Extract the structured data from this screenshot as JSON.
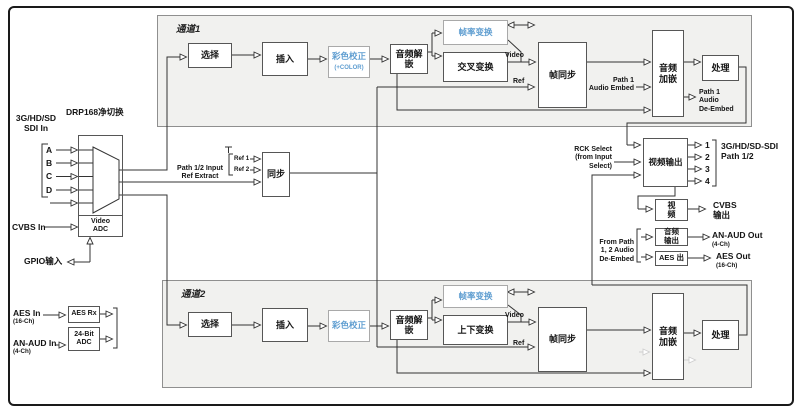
{
  "inputs": {
    "sdi_group": "3G/HD/SD\nSDI In",
    "sdi_a": "A",
    "sdi_b": "B",
    "sdi_c": "C",
    "sdi_d": "D",
    "cvbs": "CVBS In",
    "gpio": "GPIO输入",
    "aes": "AES In",
    "aes_sub": "(16-Ch)",
    "an_aud": "AN-AUD In",
    "an_aud_sub": "(4-Ch)",
    "aes_rx": "AES Rx",
    "adc": "24-Bit\nADC"
  },
  "router": {
    "title": "DRP168净切换",
    "video_adc": "Video\nADC"
  },
  "sync": {
    "label": "同步",
    "ref1": "Ref 1",
    "ref2": "Ref 2",
    "ref_extract": "Path 1/2 Input\nRef Extract"
  },
  "channel1": {
    "title": "通道1",
    "select": "选择",
    "insert": "插入",
    "color_correct": "彩色校正",
    "color_correct_sub": "(+COLOR)",
    "audio_deembed": "音频解\n嵌",
    "frame_rate": "帧率变换",
    "cross_conv": "交叉变换",
    "video": "Video",
    "ref": "Ref",
    "frame_sync": "帧同步",
    "embed_in": "Path 1\nAudio Embed",
    "audio_embed": "音频\n加嵌",
    "process": "处理",
    "deembed_out": "Path 1\nAudio\nDe-Embed"
  },
  "channel2": {
    "title": "通道2",
    "select": "选择",
    "insert": "插入",
    "color_correct": "彩色校正",
    "audio_deembed": "音频解\n嵌",
    "frame_rate": "帧率变换",
    "updown_conv": "上下变换",
    "video": "Video",
    "ref": "Ref",
    "frame_sync": "帧同步",
    "audio_embed": "音频\n加嵌",
    "process": "处理"
  },
  "outputs": {
    "rck": "RCK Select\n(from Input\nSelect)",
    "video_out": "视频输出",
    "ports": [
      "1",
      "2",
      "3",
      "4"
    ],
    "sdi_out": "3G/HD/SD-SDI\nPath 1/2",
    "video_dac": "视\n频",
    "cvbs": "CVBS\n输出",
    "from_path": "From Path\n1, 2 Audio\nDe-Embed",
    "audio_out": "音频\n输出",
    "an_aud": "AN-AUD Out",
    "an_aud_sub": "(4-Ch)",
    "aes_box": "AES 出",
    "aes": "AES Out",
    "aes_sub": "(16-Ch)"
  },
  "colors": {
    "accent_blue": "#5e9dd0",
    "channel_fill": "#f1f1ef",
    "line": "#333333"
  }
}
